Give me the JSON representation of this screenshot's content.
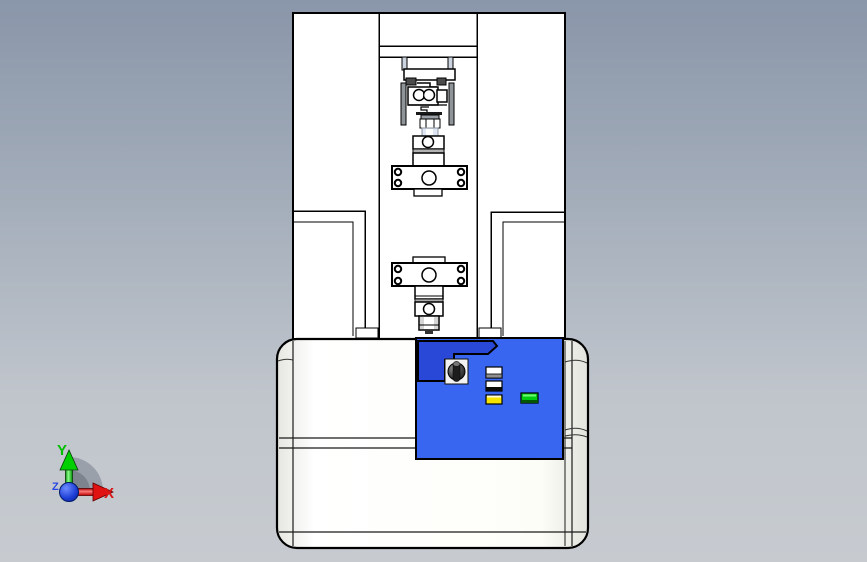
{
  "viewport": {
    "triad": {
      "x_label": "X",
      "y_label": "Y",
      "z_label": "Z"
    }
  },
  "colors": {
    "background_top": "#8a96a9",
    "background_bottom": "#c7cbd0",
    "machine_fill": "#ffffff",
    "machine_outline": "#000000",
    "base_fill": "#fdfdf8",
    "column_gray": "#8f9499",
    "panel_blue": "#3866f0",
    "panel_swoosh_blue": "#2a48d8",
    "button_white": "#ffffff",
    "button_yellow": "#f6e400",
    "button_green": "#00cc11",
    "axis_x_red": "#d81717",
    "axis_y_green": "#00bf00",
    "axis_z_blue": "#2747e0",
    "origin_sphere_blue": "#1534c8"
  }
}
